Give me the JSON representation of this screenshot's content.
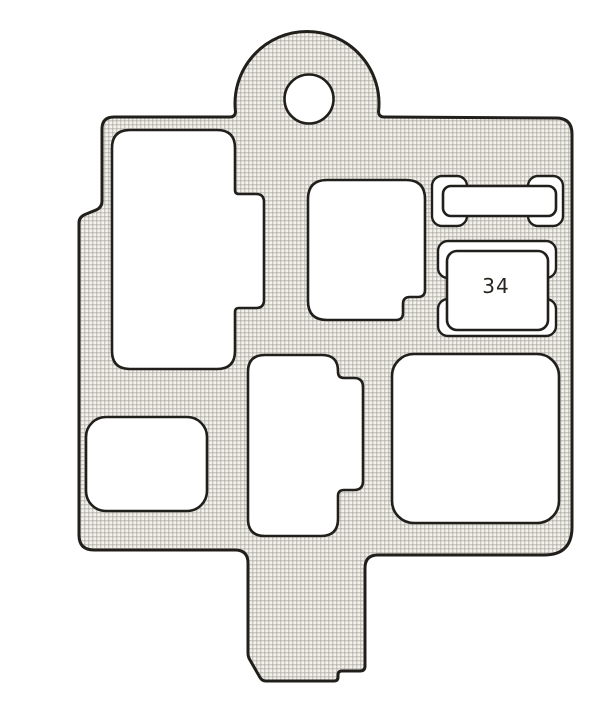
{
  "figure": {
    "type": "fuse-box-cover-diagram",
    "relay_label": "34",
    "colors": {
      "background": "#ffffff",
      "cutout_fill": "#ffffff",
      "outline": "#201f1b",
      "mesh_base": "#f3f2ee",
      "mesh_line": "#ccc9c2",
      "mesh_node": "#b8b5ae"
    }
  }
}
